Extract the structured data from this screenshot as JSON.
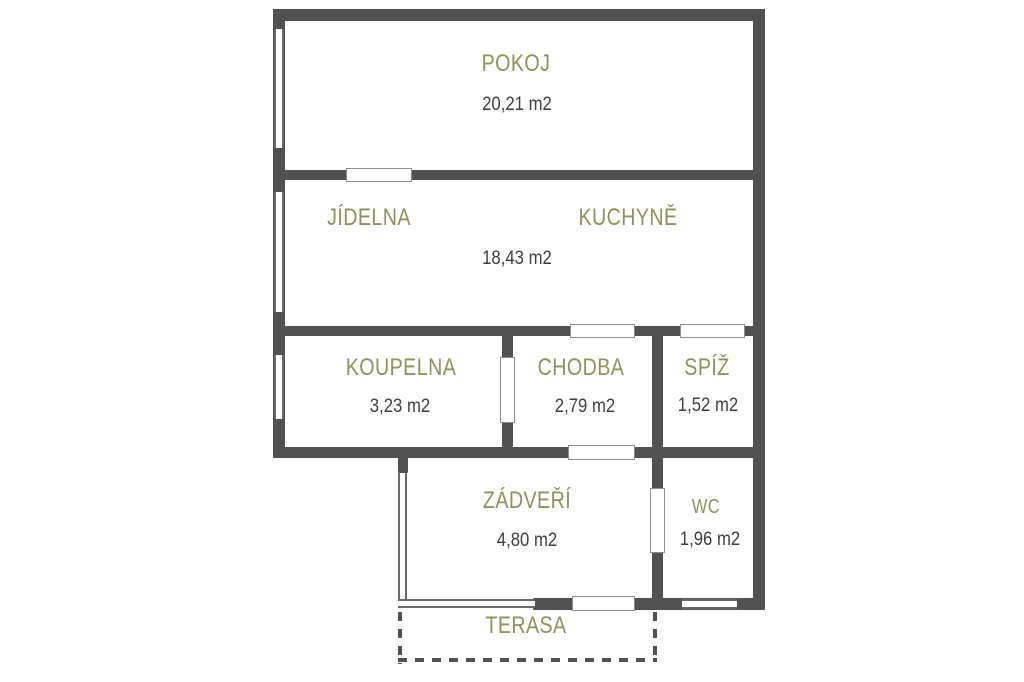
{
  "palette": {
    "wall": "#515151",
    "window_line": "#6a6a6a",
    "door_line": "#8c8c8c",
    "room_label": "#8e9158",
    "area_text": "#3d3d3d",
    "background": "#ffffff"
  },
  "rooms": {
    "pokoj": {
      "label": "POKOJ",
      "area": "20,21 m2"
    },
    "jidelna": {
      "label": "JÍDELNA"
    },
    "kuchyne": {
      "label": "KUCHYNĚ"
    },
    "jidelna_kuchyne": {
      "area": "18,43 m2"
    },
    "koupelna": {
      "label": "KOUPELNA",
      "area": "3,23 m2"
    },
    "chodba": {
      "label": "CHODBA",
      "area": "2,79 m2"
    },
    "spiz": {
      "label": "SPÍŽ",
      "area": "1,52 m2"
    },
    "zadveri": {
      "label": "ZÁDVEŘÍ",
      "area": "4,80 m2"
    },
    "wc": {
      "label": "WC",
      "area": "1,96 m2"
    },
    "terasa": {
      "label": "TERASA"
    }
  }
}
